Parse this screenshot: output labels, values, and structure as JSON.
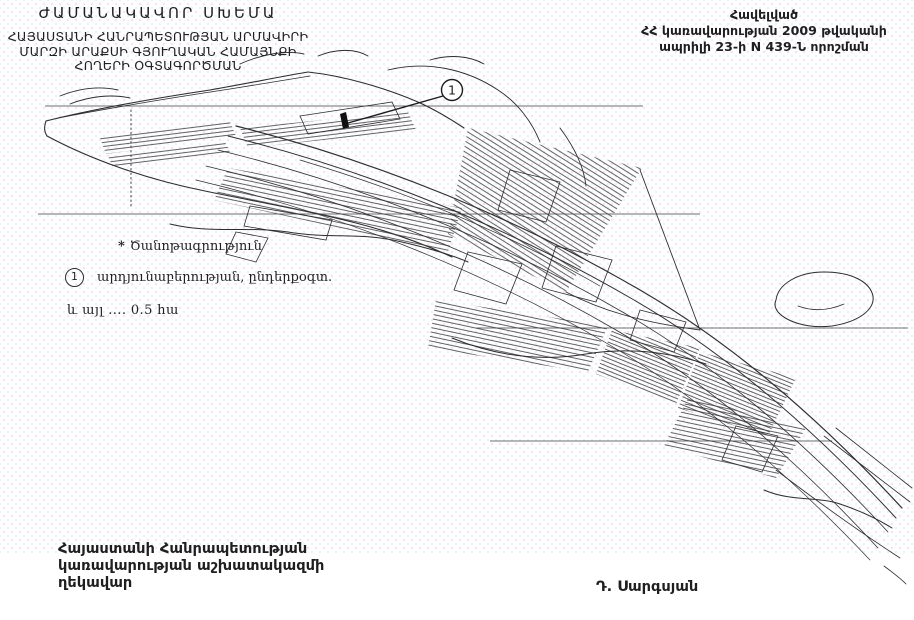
{
  "colors": {
    "ink": "#2b2b2b",
    "rule_line": "#4a4a4a",
    "paper": "#fefefe"
  },
  "header": {
    "title": "ԺԱՄԱՆԱԿԱՎՈՐ ՍԽԵՄԱ",
    "subtitle_lines": [
      "ՀԱՅԱՍՏԱՆԻ ՀԱՆՐԱՊԵՏՈՒԹՅԱՆ ԱՐՄԱՎԻՐԻ",
      "ՄԱՐԶԻ ԱՐԱՔՍԻ ԳՅՈՒՂԱԿԱՆ ՀԱՄԱՅՆՔԻ",
      "ՀՈՂԵՐԻ ՕԳՏԱԳՈՐԾՄԱՆ"
    ]
  },
  "annex_note": {
    "lines": [
      "Հավելված",
      "ՀՀ կառավարության 2009 թվականի",
      "ապրիլի 23-ի N 439-Ն որոշման"
    ]
  },
  "legend": {
    "note_marker": "*",
    "note_label": "Ծանոթագրություն",
    "item_marker": "1",
    "item_label": "արդյունաբերության, ընդերքօգտ.",
    "area_line": "և այլ .... 0.5  հա"
  },
  "map": {
    "marker_label": "1"
  },
  "signature": {
    "title_lines": [
      "Հայաստանի Հանրապետության",
      "կառավարության աշխատակազմի",
      "ղեկավար"
    ],
    "name": "Դ. Սարգսյան"
  }
}
